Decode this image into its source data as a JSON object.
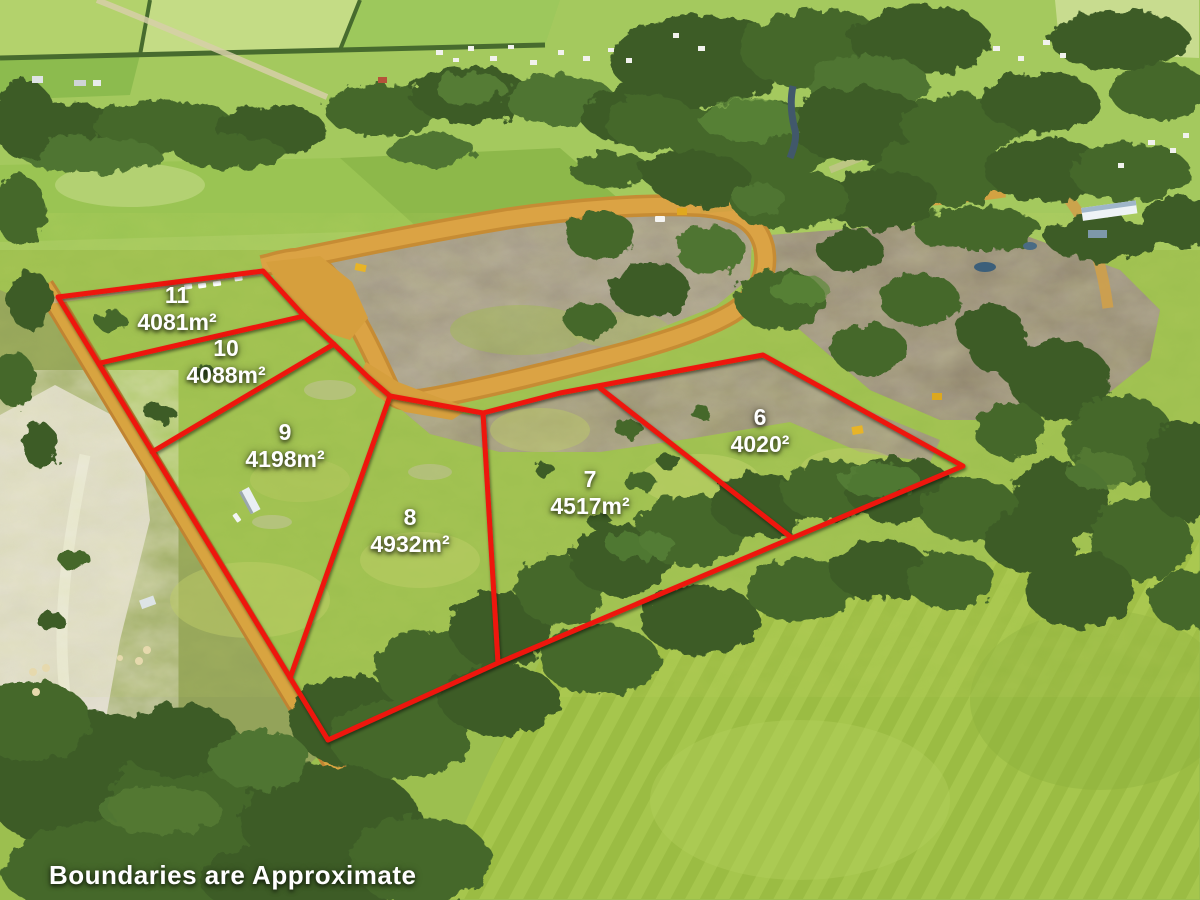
{
  "lots": [
    {
      "number": "11",
      "area": "4081m²"
    },
    {
      "number": "10",
      "area": "4088m²"
    },
    {
      "number": "9",
      "area": "4198m²"
    },
    {
      "number": "8",
      "area": "4932m²"
    },
    {
      "number": "7",
      "area": "4517m²"
    },
    {
      "number": "6",
      "area": "4020²"
    }
  ],
  "disclaimer": "Boundaries are Approximate",
  "colors": {
    "boundary_red": "#ee1410",
    "label_white": "#ffffff",
    "road_orange": "#d8a03c",
    "pasture_green": "#9cbf4f",
    "forest_green": "#41612a",
    "cleared_earth": "#a69a8a"
  }
}
